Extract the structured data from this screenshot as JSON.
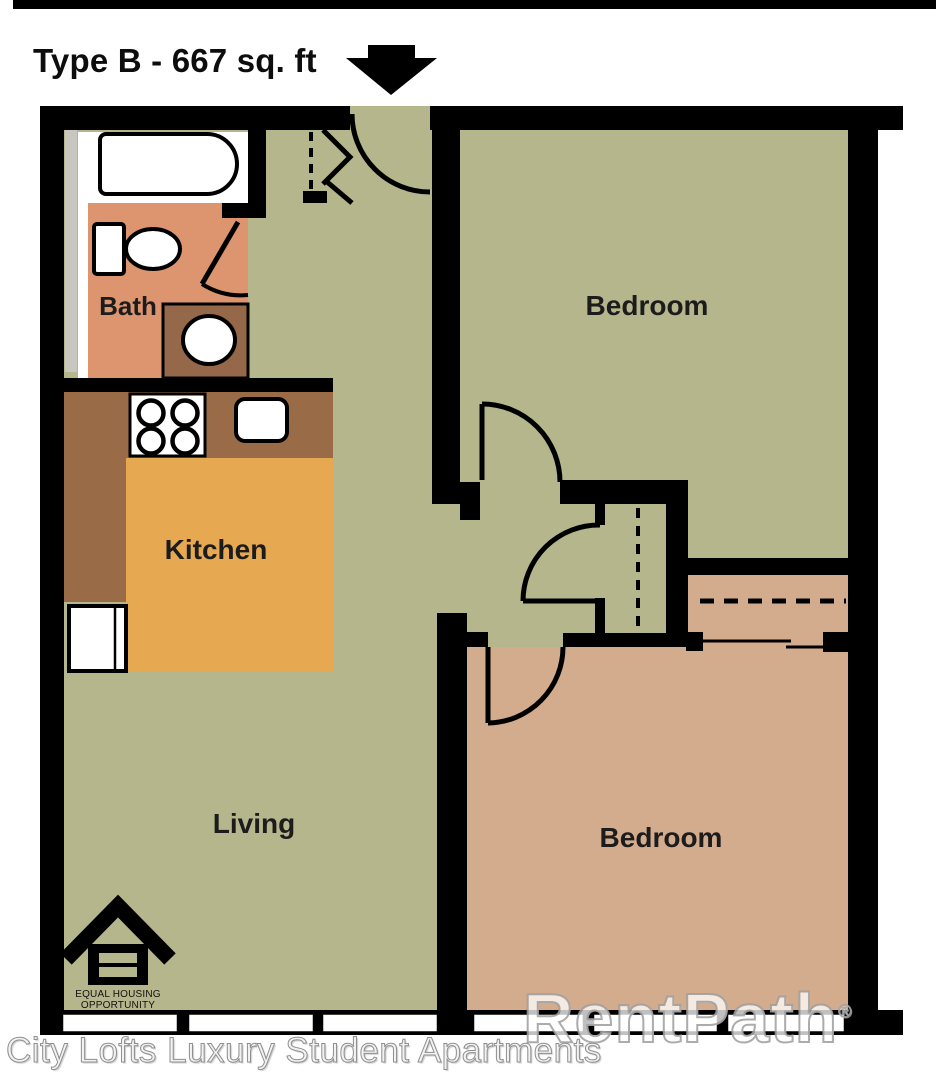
{
  "header": {
    "title": "Type B - 667 sq. ft"
  },
  "floor_plan": {
    "rooms": {
      "bath": "Bath",
      "kitchen": "Kitchen",
      "living": "Living",
      "bedroom_top": "Bedroom",
      "bedroom_bottom": "Bedroom"
    },
    "icons": [
      "entry-arrow-icon",
      "bathtub-icon",
      "toilet-icon",
      "vanity-sink-icon",
      "stove-icon",
      "kitchen-sink-icon",
      "fridge-icon",
      "equal-housing-logo"
    ],
    "colors": {
      "room_green": "#b5b68c",
      "bath_salmon": "#dd9570",
      "kitchen_orange": "#e6a851",
      "counter_brown": "#9a6b47",
      "bedroom_tan": "#d3ab8d",
      "wall_black": "#000000",
      "chase_gray": "#c9c6bf"
    }
  },
  "equal_housing": {
    "line1": "EQUAL HOUSING",
    "line2": "OPPORTUNITY"
  },
  "watermark": {
    "text": "RentPath",
    "registered": "®"
  },
  "caption": "City Lofts Luxury Student Apartments"
}
